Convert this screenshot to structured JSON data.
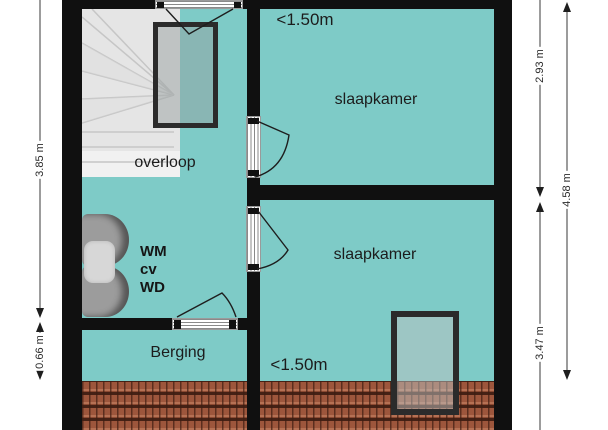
{
  "floorplan": {
    "labels": {
      "overloop": "overloop",
      "slaapkamer_top": "slaapkamer",
      "slaapkamer_bottom": "slaapkamer",
      "berging": "Berging",
      "height_restriction_top": "<1.50m",
      "height_restriction_bottom": "<1.50m"
    },
    "appliances": {
      "wm": "WM",
      "cv": "cv",
      "wd": "WD"
    },
    "dimensions": {
      "left_main": "3.85 m",
      "left_small": "0.66 m",
      "right_inner_top": "2.93 m",
      "right_inner_bottom": "3.47 m",
      "right_outer": "4.58 m"
    },
    "colors": {
      "room_fill": "#7ecbc7",
      "wall": "#101010",
      "roof_tile": "#9d563c",
      "stairs": "#e5e5e5",
      "roof_window_frame": "#2b2b2b"
    }
  }
}
